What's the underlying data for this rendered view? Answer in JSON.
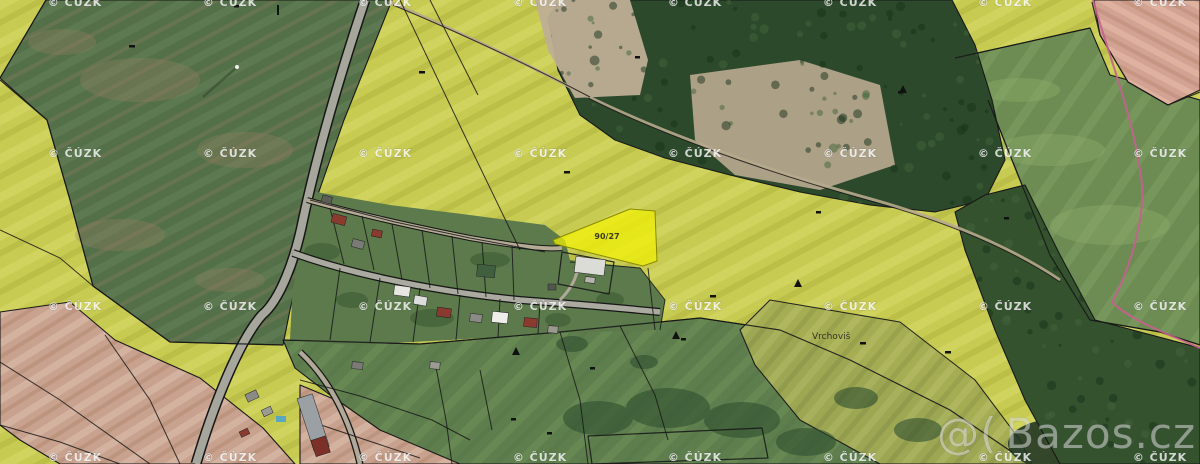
{
  "map": {
    "highlighted_parcel": {
      "label": "90/27",
      "fill": "#f2f104",
      "outline": "#8a8a00"
    },
    "place_label": "Vrchoviš",
    "colors": {
      "rapeseed_field": "#c7cb52",
      "green_field": "#547049",
      "forest": "#2c4a2b",
      "bare_soil": "#c8a28e",
      "plowed_field": "#d2a292",
      "road": "#a6a69c",
      "cadastral_line": "#181818",
      "other_boundary_magenta": "#c75f8f"
    }
  },
  "watermarks": {
    "cuzk": "© ČÚZK",
    "bazos_logo": "@(",
    "bazos_text": "Bazos.cz"
  }
}
